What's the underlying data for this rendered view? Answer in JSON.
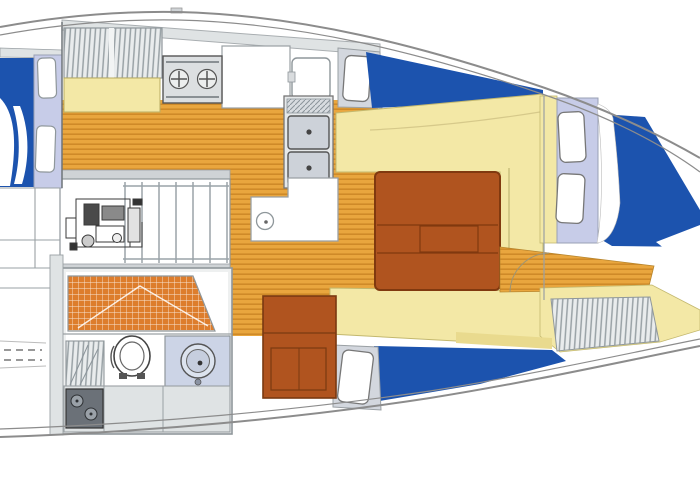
{
  "meta": {
    "kind": "sailboat-interior-floorplan",
    "orientation": "bow-right"
  },
  "colors": {
    "deck-blue": "#1c53ae",
    "cabin-lavender": "#c7cce8",
    "berth-yellow": "#f3e8a6",
    "berth-yellow-dark": "#e9da8e",
    "sole-orange": "#e9a63e",
    "sole-stripe": "#cf8a28",
    "tile-orange": "#dd7d2c",
    "wood-brown": "#b0541f",
    "wood-brown-dark": "#80390f",
    "panel-gray": "#dfe3e4",
    "steel-gray": "#cfd3d6",
    "sink-gray": "#cdd2d9",
    "head-counter": "#ccd4e6",
    "dark-sink": "#6b7178",
    "hull-line": "#8c8c8c",
    "wall-line": "#777d81"
  },
  "parts": [
    {
      "name": "hull-outline",
      "desc": "sheer and rubbing-strake lines of the hull"
    },
    {
      "name": "foredeck-blue",
      "desc": "blue foredeck at bow"
    },
    {
      "name": "anchor-locker-wedge",
      "desc": "white wedge at bow"
    },
    {
      "name": "bow-hatch-forward",
      "desc": "deck hatch on foredeck coachroof"
    },
    {
      "name": "bow-hatch-aft",
      "desc": "deck hatch on foredeck coachroof"
    },
    {
      "name": "v-berth",
      "desc": "forward cabin berth cushions"
    },
    {
      "name": "forward-lockers",
      "desc": "louvered lockers in forecabin"
    },
    {
      "name": "forward-cabin-sole",
      "desc": "wood sole strip in forecabin"
    },
    {
      "name": "saloon-table",
      "desc": "drop-leaf saloon table"
    },
    {
      "name": "settee",
      "desc": "saloon settee cushions"
    },
    {
      "name": "mast-base",
      "desc": "mast position on counter"
    },
    {
      "name": "galley-stove",
      "desc": "two-burner stove"
    },
    {
      "name": "galley-double-sink",
      "desc": "twin sink basins"
    },
    {
      "name": "icebox-lid",
      "desc": "top-loading icebox door"
    },
    {
      "name": "galley-counter",
      "desc": "L-shaped worktop"
    },
    {
      "name": "galley-lockers",
      "desc": "louvered galley lockers"
    },
    {
      "name": "quarter-berth",
      "desc": "aft berth cushion"
    },
    {
      "name": "companionway-steps",
      "desc": "ladder down from cockpit"
    },
    {
      "name": "engine",
      "desc": "engine under companionway"
    },
    {
      "name": "head-compartment",
      "desc": "bathroom"
    },
    {
      "name": "shower-floor",
      "desc": "tiled shower pan"
    },
    {
      "name": "toilet",
      "desc": "marine toilet"
    },
    {
      "name": "washbasin",
      "desc": "round basin on vanity"
    },
    {
      "name": "vanity-locker",
      "desc": "louvered locker in head"
    },
    {
      "name": "aft-sink-unit",
      "desc": "small twin-basin unit"
    },
    {
      "name": "mid-deck-hatch",
      "desc": "coachroof hatch amidships"
    },
    {
      "name": "port-deck-hatch",
      "desc": "coachroof hatch port side"
    },
    {
      "name": "aft-cabinet",
      "desc": "wood cabinet aft of saloon"
    },
    {
      "name": "cockpit-lockers",
      "desc": "stern lockers and seats"
    },
    {
      "name": "transom-detail",
      "desc": "dashed swim-ladder lines at stern"
    }
  ]
}
